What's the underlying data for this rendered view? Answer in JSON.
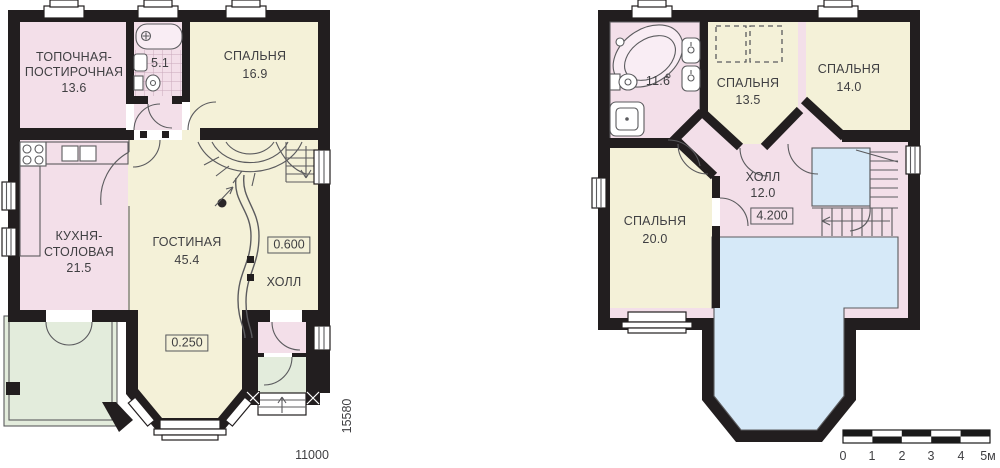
{
  "colors": {
    "wall": "#221e1f",
    "cream": "#f4f1d8",
    "pink": "#f3dfe9",
    "pink_light": "#f9edf4",
    "green": "#e3ecdc",
    "blue": "#d6e9f8",
    "tile": "#c9a9bc",
    "line": "#5b5b5e",
    "text": "#3f3f42"
  },
  "floor1": {
    "boiler_room": {
      "name_line1": "ТОПОЧНАЯ-",
      "name_line2": "ПОСТИРОЧНАЯ",
      "area": "13.6"
    },
    "bathroom": {
      "area": "5.1"
    },
    "bedroom": {
      "name": "СПАЛЬНЯ",
      "area": "16.9"
    },
    "kitchen": {
      "name_line1": "КУХНЯ-",
      "name_line2": "СТОЛОВАЯ",
      "area": "21.5"
    },
    "living_room": {
      "name": "ГОСТИНАЯ",
      "area": "45.4"
    },
    "hall": {
      "name": "ХОЛЛ"
    },
    "level_marks": {
      "hall": "0.600",
      "living": "0.250"
    },
    "dimensions": {
      "width": "11000",
      "depth": "15580"
    }
  },
  "floor2": {
    "bathroom": {
      "area": "11.6"
    },
    "bedroom_1": {
      "name": "СПАЛЬНЯ",
      "area": "13.5"
    },
    "bedroom_2": {
      "name": "СПАЛЬНЯ",
      "area": "14.0"
    },
    "bedroom_3": {
      "name": "СПАЛЬНЯ",
      "area": "20.0"
    },
    "hall": {
      "name": "ХОЛЛ",
      "area": "12.0"
    },
    "level_marks": {
      "hall": "4.200"
    }
  },
  "scale_bar": {
    "ticks": [
      "0",
      "1",
      "2",
      "3",
      "4",
      "5м"
    ]
  }
}
